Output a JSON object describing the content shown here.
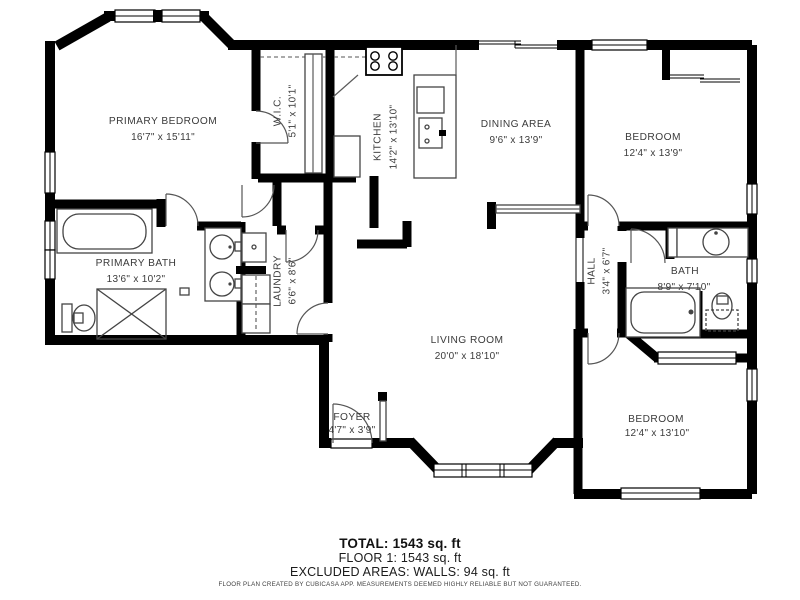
{
  "floorplan": {
    "rooms": [
      {
        "id": "primary-bedroom",
        "name": "PRIMARY BEDROOM",
        "dims": "16'7\" x 15'11\""
      },
      {
        "id": "wic",
        "name": "W.I.C.",
        "dims": "5'1\" x 10'1\""
      },
      {
        "id": "kitchen",
        "name": "KITCHEN",
        "dims": "14'2\" x 13'10\""
      },
      {
        "id": "dining-area",
        "name": "DINING AREA",
        "dims": "9'6\" x 13'9\""
      },
      {
        "id": "bedroom-top",
        "name": "BEDROOM",
        "dims": "12'4\" x 13'9\""
      },
      {
        "id": "primary-bath",
        "name": "PRIMARY BATH",
        "dims": "13'6\" x 10'2\""
      },
      {
        "id": "laundry",
        "name": "LAUNDRY",
        "dims": "6'6\" x 8'6\""
      },
      {
        "id": "hall",
        "name": "HALL",
        "dims": "3'4\" x 6'7\""
      },
      {
        "id": "bath",
        "name": "BATH",
        "dims": "8'9\" x 7'10\""
      },
      {
        "id": "living-room",
        "name": "LIVING ROOM",
        "dims": "20'0\" x 18'10\""
      },
      {
        "id": "foyer",
        "name": "FOYER",
        "dims": "4'7\" x 3'9\""
      },
      {
        "id": "bedroom-bottom",
        "name": "BEDROOM",
        "dims": "12'4\" x 13'10\""
      }
    ],
    "summary": {
      "total": "TOTAL: 1543 sq. ft",
      "floor": "FLOOR 1: 1543 sq. ft",
      "excluded": "EXCLUDED AREAS: WALLS: 94 sq. ft"
    },
    "disclaimer": "FLOOR PLAN CREATED BY CUBICASA APP. MEASUREMENTS DEEMED HIGHLY RELIABLE BUT NOT GUARANTEED.",
    "colors": {
      "wall": "#000000",
      "background": "#ffffff",
      "label_text": "#3b3b3b",
      "summary_text": "#111111"
    }
  }
}
